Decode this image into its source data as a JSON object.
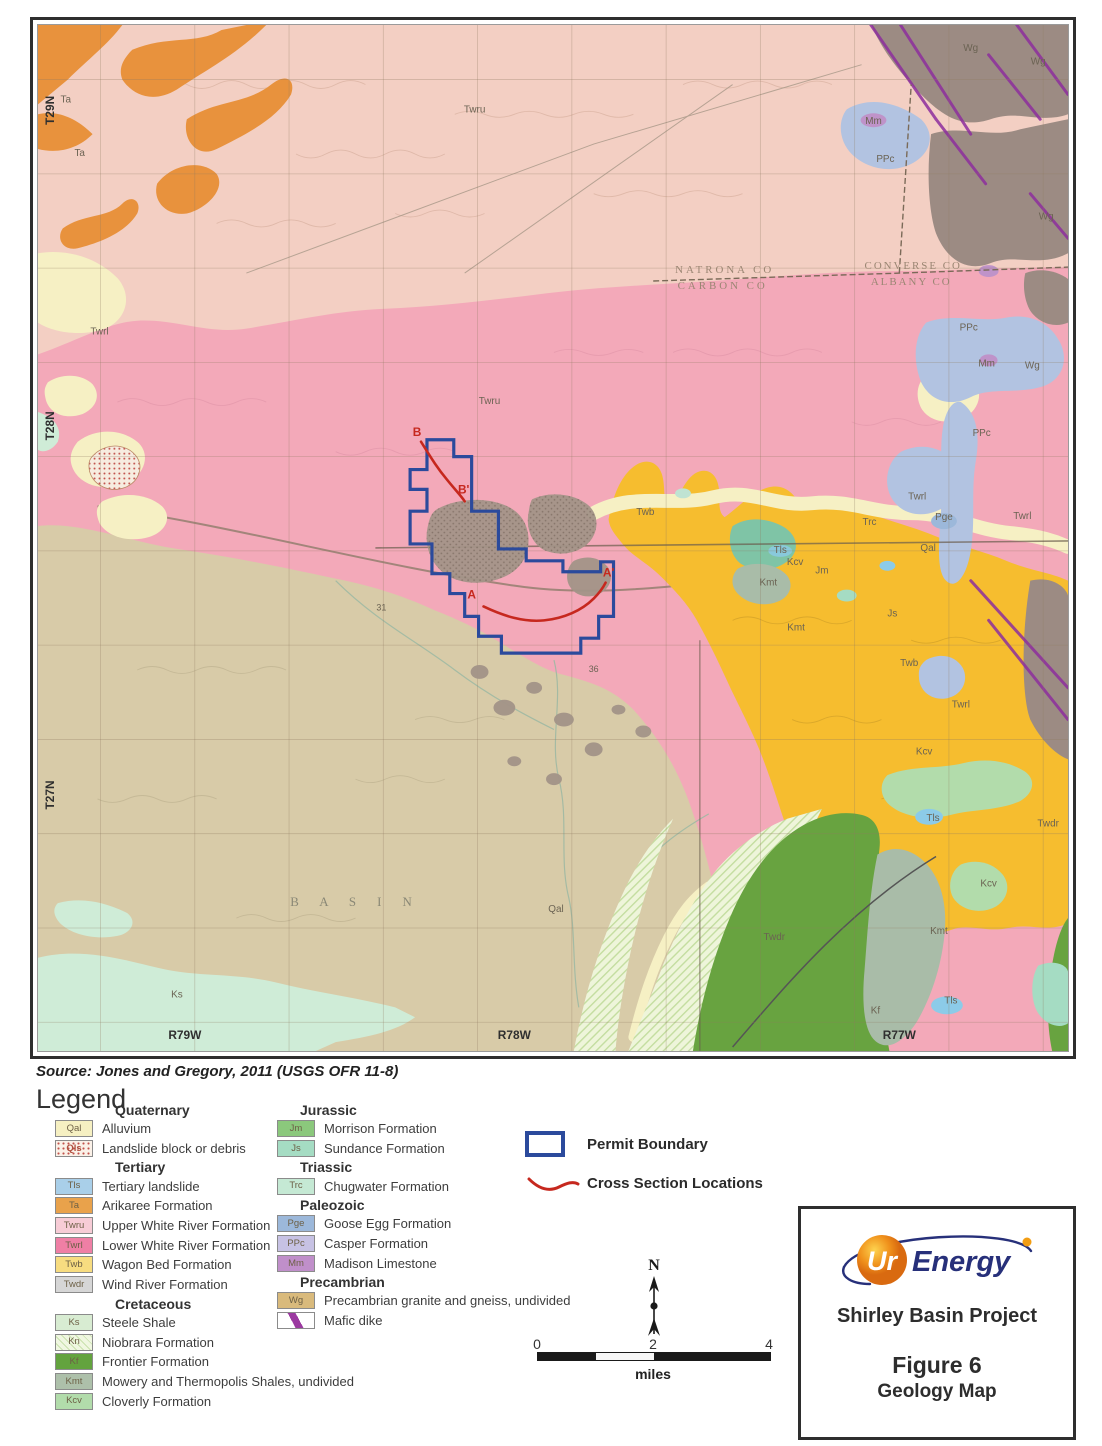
{
  "source_note": "Source:  Jones and Gregory, 2011 (USGS OFR 11-8)",
  "legend": {
    "title": "Legend",
    "left_groups": [
      {
        "era": "Quaternary",
        "items": [
          {
            "code": "Qal",
            "label": "Alluvium",
            "bg": "#f6f0c2"
          },
          {
            "code": "Qls",
            "label": "Landslide block or debris",
            "type": "dots"
          }
        ]
      },
      {
        "era": "Tertiary",
        "items": [
          {
            "code": "Tls",
            "label": "Tertiary landslide",
            "bg": "#a9cfe9"
          },
          {
            "code": "Ta",
            "label": "Arikaree Formation",
            "bg": "#e9a24b"
          },
          {
            "code": "Twru",
            "label": "Upper White River Formation",
            "bg": "#f7ccd6"
          },
          {
            "code": "Twrl",
            "label": "Lower White River Formation",
            "bg": "#ef7fa5"
          },
          {
            "code": "Twb",
            "label": "Wagon Bed Formation",
            "bg": "#f7dc80"
          },
          {
            "code": "Twdr",
            "label": "Wind River Formation",
            "bg": "#d6d6d6"
          }
        ]
      },
      {
        "era": "Cretaceous",
        "items": [
          {
            "code": "Ks",
            "label": "Steele Shale",
            "bg": "#d8ecd2"
          },
          {
            "code": "Kn",
            "label": "Niobrara Formation",
            "type": "hatch"
          },
          {
            "code": "Kf",
            "label": "Frontier Formation",
            "bg": "#63a33e"
          },
          {
            "code": "Kmt",
            "label": "Mowery and Thermopolis Shales, undivided",
            "bg": "#adc0aa"
          },
          {
            "code": "Kcv",
            "label": "Cloverly Formation",
            "bg": "#b2dcab"
          }
        ]
      }
    ],
    "right_groups": [
      {
        "era": "Jurassic",
        "items": [
          {
            "code": "Jm",
            "label": "Morrison Formation",
            "bg": "#8bc87c"
          },
          {
            "code": "Js",
            "label": "Sundance Formation",
            "bg": "#a5dcc3"
          }
        ]
      },
      {
        "era": "Triassic",
        "items": [
          {
            "code": "Trc",
            "label": "Chugwater Formation",
            "bg": "#c5e9d4"
          }
        ]
      },
      {
        "era": "Paleozoic",
        "items": [
          {
            "code": "Pge",
            "label": "Goose Egg Formation",
            "bg": "#9cb8da"
          },
          {
            "code": "PPc",
            "label": "Casper Formation",
            "bg": "#c7c2e4"
          },
          {
            "code": "Mm",
            "label": "Madison Limestone",
            "bg": "#c08fca"
          }
        ]
      },
      {
        "era": "Precambrian",
        "items": [
          {
            "code": "Wg",
            "label": "Precambrian granite and gneiss, undivided",
            "bg": "#d9ba7c"
          },
          {
            "code": "",
            "label": "Mafic dike",
            "type": "dike"
          }
        ]
      }
    ]
  },
  "overlay_legend": {
    "permit_label": "Permit Boundary",
    "cross_label": "Cross Section Locations"
  },
  "north_label": "N",
  "scale_bar": {
    "ticks": [
      "0",
      "2",
      "4"
    ],
    "unit": "miles"
  },
  "title_block": {
    "logo_prefix": "Ur",
    "logo_suffix": "Energy",
    "project": "Shirley Basin Project",
    "figure": "Figure 6",
    "subtitle": "Geology Map"
  },
  "map": {
    "colors": {
      "twru": "#f3cfc3",
      "twrl": "#f3a9b9",
      "twdr": "#d8cba8",
      "twb": "#f6bd2f",
      "ta": "#e8923d",
      "wg": "#9c8b83",
      "ppc": "#b2c3e1",
      "qal": "#f6f0c4",
      "mm": "#bf93c9",
      "pge": "#9cb8da",
      "ks": "#cfecd7",
      "kf": "#68a340",
      "kmt": "#a9bca8",
      "kcv": "#b2dcab",
      "kn": "#eef5da",
      "js": "#a5dcc3",
      "tls": "#8ccbe8",
      "teal": "#7fc4a6",
      "stipple": "#a39488",
      "dike": "#8d2f9e",
      "permit": "#2b4a9c",
      "cross": "#c6281e"
    },
    "townships": [
      "T29N",
      "T28N",
      "T27N"
    ],
    "ranges": [
      "R79W",
      "R78W",
      "R77W"
    ],
    "counties": [
      "NATRONA CO",
      "CARBON CO",
      "CONVERSE CO",
      "ALBANY CO"
    ],
    "basin_label": "B A S I N",
    "unit_labels": [
      {
        "t": "T29N",
        "x": 16,
        "y": 86,
        "s": 12,
        "c": "#2f2f2f",
        "w": 1,
        "r": -90
      },
      {
        "t": "T28N",
        "x": 16,
        "y": 404,
        "s": 12,
        "c": "#2f2f2f",
        "w": 1,
        "r": -90
      },
      {
        "t": "T27N",
        "x": 16,
        "y": 776,
        "s": 12,
        "c": "#2f2f2f",
        "w": 1,
        "r": -90
      },
      {
        "t": "R79W",
        "x": 148,
        "y": 1022,
        "s": 12,
        "c": "#2f2f2f",
        "w": 1
      },
      {
        "t": "R78W",
        "x": 480,
        "y": 1022,
        "s": 12,
        "c": "#2f2f2f",
        "w": 1
      },
      {
        "t": "R77W",
        "x": 868,
        "y": 1022,
        "s": 12,
        "c": "#2f2f2f",
        "w": 1
      },
      {
        "t": "NATRONA CO",
        "x": 692,
        "y": 250,
        "s": 11,
        "c": "#9b8673",
        "ls": 3,
        "f": 1
      },
      {
        "t": "CARBON CO",
        "x": 690,
        "y": 266,
        "s": 11,
        "c": "#9b8673",
        "ls": 3,
        "f": 1
      },
      {
        "t": "CONVERSE CO",
        "x": 882,
        "y": 246,
        "s": 11,
        "c": "#9b8673",
        "ls": 2,
        "f": 1
      },
      {
        "t": "ALBANY CO",
        "x": 880,
        "y": 262,
        "s": 11,
        "c": "#9b8673",
        "ls": 2,
        "f": 1
      },
      {
        "t": "B A S I N",
        "x": 320,
        "y": 888,
        "s": 13,
        "c": "#8a8876",
        "ls": 9,
        "f": 1
      },
      {
        "t": "Twru",
        "x": 440,
        "y": 88
      },
      {
        "t": "Twru",
        "x": 455,
        "y": 382
      },
      {
        "t": "Ta",
        "x": 28,
        "y": 78
      },
      {
        "t": "Ta",
        "x": 42,
        "y": 132
      },
      {
        "t": "Twrl",
        "x": 62,
        "y": 312
      },
      {
        "t": "Twrl",
        "x": 886,
        "y": 478
      },
      {
        "t": "Twrl",
        "x": 992,
        "y": 498
      },
      {
        "t": "Twrl",
        "x": 930,
        "y": 688
      },
      {
        "t": "Twb",
        "x": 612,
        "y": 494
      },
      {
        "t": "Twb",
        "x": 878,
        "y": 646
      },
      {
        "t": "Qal",
        "x": 897,
        "y": 530
      },
      {
        "t": "Qal",
        "x": 522,
        "y": 894
      },
      {
        "t": "Trc",
        "x": 838,
        "y": 504
      },
      {
        "t": "Jm",
        "x": 790,
        "y": 553
      },
      {
        "t": "Js",
        "x": 861,
        "y": 596
      },
      {
        "t": "Tls",
        "x": 748,
        "y": 532
      },
      {
        "t": "Tls",
        "x": 902,
        "y": 802
      },
      {
        "t": "Tls",
        "x": 920,
        "y": 986
      },
      {
        "t": "Kcv",
        "x": 763,
        "y": 544
      },
      {
        "t": "Kcv",
        "x": 893,
        "y": 735
      },
      {
        "t": "Kcv",
        "x": 958,
        "y": 868
      },
      {
        "t": "Kmt",
        "x": 736,
        "y": 565
      },
      {
        "t": "Kmt",
        "x": 764,
        "y": 610
      },
      {
        "t": "Kmt",
        "x": 908,
        "y": 916
      },
      {
        "t": "PPc",
        "x": 854,
        "y": 138
      },
      {
        "t": "PPc",
        "x": 938,
        "y": 308
      },
      {
        "t": "PPc",
        "x": 951,
        "y": 414
      },
      {
        "t": "Pge",
        "x": 913,
        "y": 499
      },
      {
        "t": "Mm",
        "x": 842,
        "y": 100
      },
      {
        "t": "Mm",
        "x": 956,
        "y": 344
      },
      {
        "t": "Wg",
        "x": 940,
        "y": 26
      },
      {
        "t": "Wg",
        "x": 1008,
        "y": 40
      },
      {
        "t": "Wg",
        "x": 1016,
        "y": 196
      },
      {
        "t": "Wg",
        "x": 1002,
        "y": 346
      },
      {
        "t": "Twdr",
        "x": 742,
        "y": 922
      },
      {
        "t": "Twdr",
        "x": 1018,
        "y": 808
      },
      {
        "t": "Kf",
        "x": 844,
        "y": 996
      },
      {
        "t": "Ks",
        "x": 140,
        "y": 980
      },
      {
        "t": "31",
        "x": 346,
        "y": 590,
        "s": 9
      },
      {
        "t": "36",
        "x": 560,
        "y": 652,
        "s": 9
      }
    ],
    "cross_section_labels": [
      {
        "t": "B",
        "x": 382,
        "y": 414,
        "s": 12,
        "c": "#c6281e",
        "w": 1
      },
      {
        "t": "B'",
        "x": 429,
        "y": 472,
        "s": 12,
        "c": "#c6281e",
        "w": 1
      },
      {
        "t": "A",
        "x": 437,
        "y": 578,
        "s": 12,
        "c": "#c6281e",
        "w": 1
      },
      {
        "t": "A'",
        "x": 575,
        "y": 556,
        "s": 12,
        "c": "#c6281e",
        "w": 1
      }
    ]
  }
}
